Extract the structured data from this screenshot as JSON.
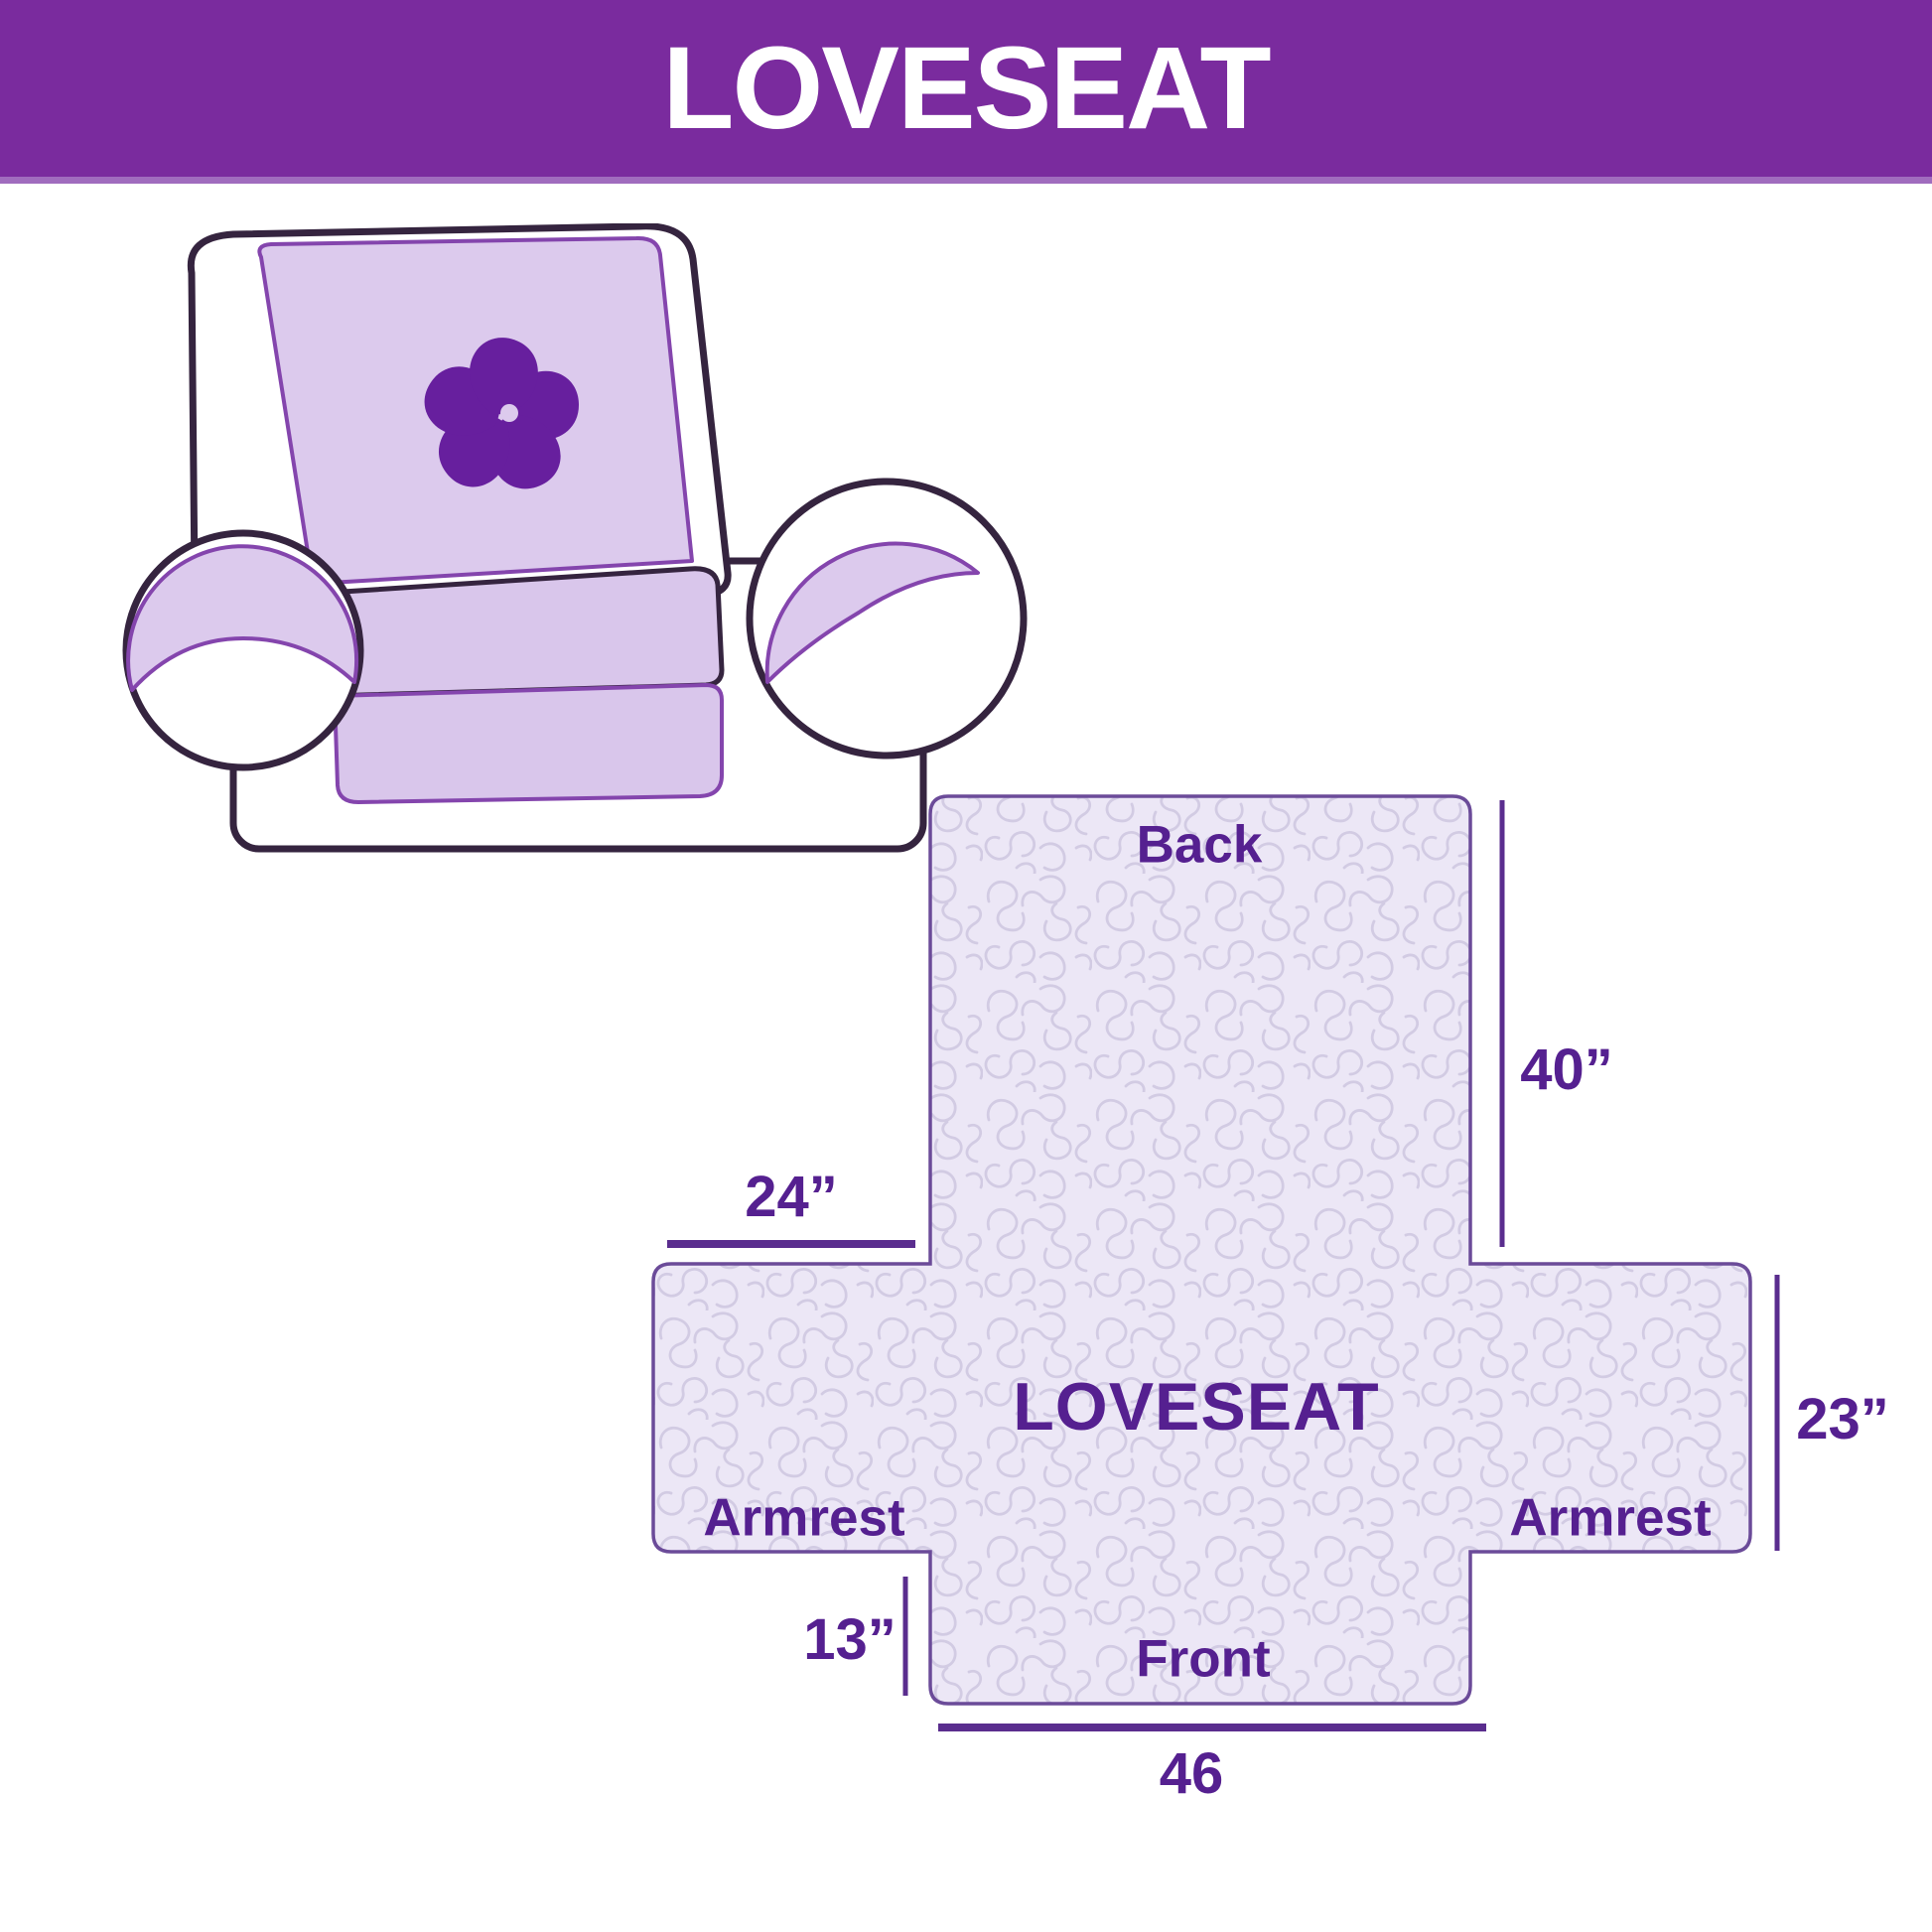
{
  "header": {
    "title": "LOVESEAT",
    "bg_color": "#7a2b9e",
    "text_color": "#ffffff"
  },
  "illustration": {
    "description": "line drawing of a two-seat loveseat sofa with lavender protective cover",
    "logo_icon": "pinwheel-icon",
    "cover_color": "#dccaed",
    "outline_color": "#35243f",
    "logo_color": "#671f9e"
  },
  "diagram": {
    "labels": {
      "back": "Back",
      "product": "LOVESEAT",
      "armrest_left": "Armrest",
      "armrest_right": "Armrest",
      "front": "Front"
    },
    "dimensions": {
      "back_height": "40”",
      "armrest_width": "24”",
      "seat_height": "23”",
      "skirt_height": "13”",
      "front_width": "46"
    },
    "fill_color": "#ece7f6",
    "texture_color": "#d2cbe3",
    "outline_color": "#6b4b99",
    "line_color": "#5a2d8e",
    "text_color": "#552090"
  }
}
